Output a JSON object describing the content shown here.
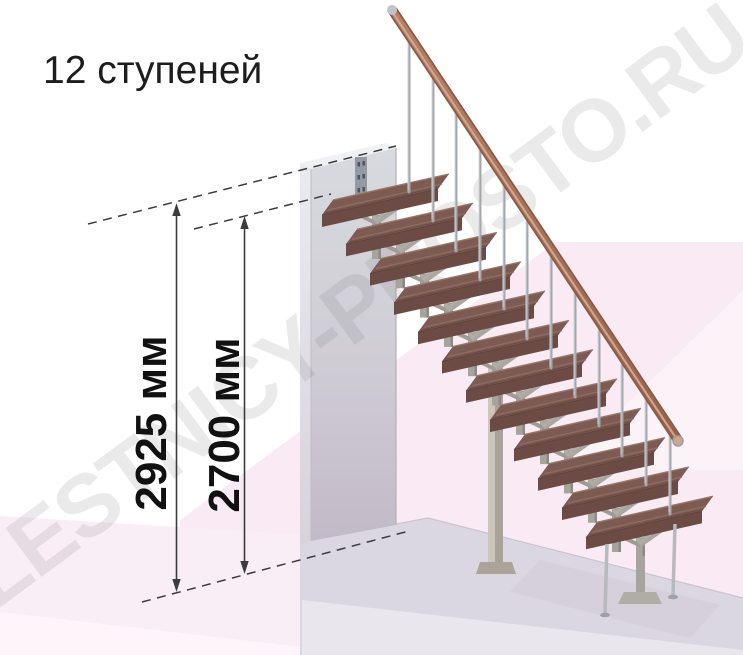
{
  "title": "12 ступеней",
  "watermark": "LESTNICY-PROSTO.RU",
  "staircase": {
    "step_count": 12
  },
  "dimensions": {
    "total_height": {
      "label": "2925 мм",
      "value": 2925,
      "unit": "мм"
    },
    "floor_to_top_tread": {
      "label": "2700 мм",
      "value": 2700,
      "unit": "мм"
    }
  },
  "colors": {
    "tread": "#7d5b53",
    "tread_front": "#6d4b45",
    "handrail": "#ab7760",
    "metal_module": "#a7a39d",
    "baluster": "#a4a8ac",
    "wall": "#cfccd4",
    "floor_pink": "#f9eaf3",
    "platform": "#dbd7e1",
    "dimension_line": "#3b3b3b",
    "dimension_text": "#111111"
  }
}
